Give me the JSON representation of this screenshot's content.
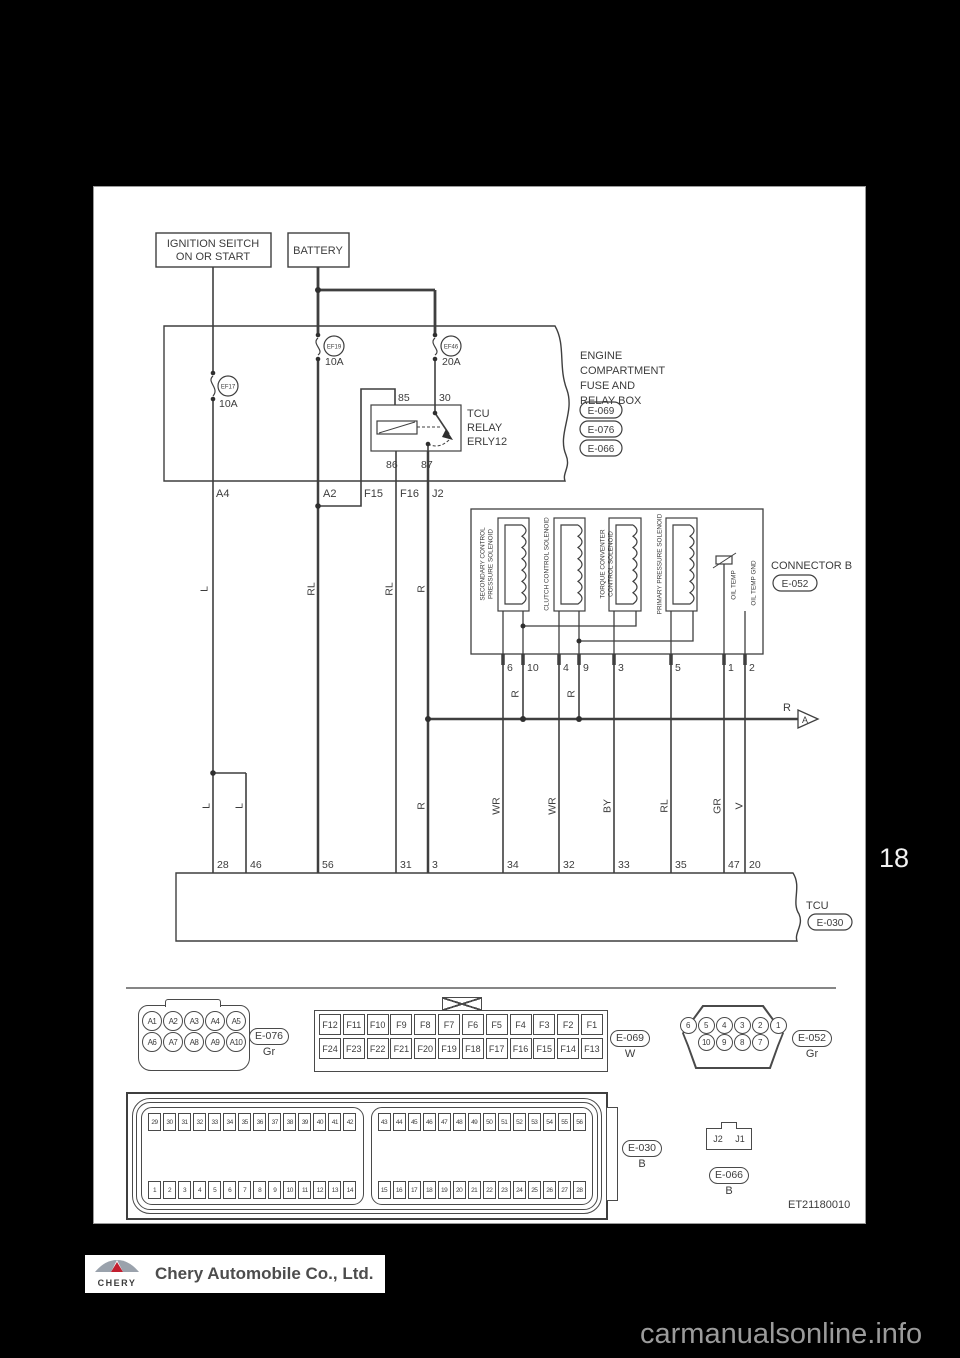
{
  "page": {
    "number": "18",
    "diagram_code": "ET21180010",
    "watermark": "carmanualsonline.info"
  },
  "footer": {
    "brand": "CHERY",
    "company": "Chery Automobile Co., Ltd."
  },
  "power": {
    "ignition_label_1": "IGNITION SEITCH",
    "ignition_label_2": "ON OR START",
    "battery_label": "BATTERY"
  },
  "fusebox": {
    "title_lines": [
      "ENGINE",
      "COMPARTMENT",
      "FUSE AND",
      "RELAY BOX"
    ],
    "badges": [
      "E-069",
      "E-076",
      "E-066"
    ],
    "fuses": {
      "ef17": {
        "id": "EF17",
        "rating": "10A"
      },
      "ef19": {
        "id": "EF19",
        "rating": "10A"
      },
      "ef46": {
        "id": "EF46",
        "rating": "20A"
      }
    },
    "relay": {
      "name_lines": [
        "TCU",
        "RELAY",
        "ERLY12"
      ],
      "pins": {
        "p85": "85",
        "p30": "30",
        "p86": "86",
        "p87": "87"
      }
    },
    "out_pins": [
      "A4",
      "A2",
      "F15",
      "F16",
      "J2"
    ]
  },
  "wires": {
    "a4": "L",
    "a2": "RL",
    "f16": "RL",
    "j2": "R",
    "b10": "R",
    "b9": "R",
    "bus": "R",
    "arrow": "A",
    "t28": "L",
    "t46": "L",
    "t3": "R",
    "t34": "WR",
    "t32": "WR",
    "t33": "BY",
    "t35": "RL",
    "t47": "GR",
    "t20": "V"
  },
  "connector_b": {
    "label": "CONNECTOR B",
    "badge": "E-052",
    "solenoids": {
      "s1": [
        "SECONDARY CONTROL",
        "PRESSURE SOLENOID"
      ],
      "s2": "CLUTCH CONTROL SOLENOID",
      "s3": [
        "TORQUE CONVENTER",
        "CONTROL SOLENOID"
      ],
      "s4": "PRIMARY PRESSURE SOLENOID",
      "oil_temp": "OIL TEMP",
      "oil_temp_gnd": "OIL TEMP GND"
    },
    "pins": [
      "6",
      "10",
      "4",
      "9",
      "3",
      "5",
      "1",
      "2"
    ]
  },
  "tcu": {
    "label": "TCU",
    "badge": "E-030",
    "pins": [
      "28",
      "46",
      "56",
      "31",
      "3",
      "34",
      "32",
      "33",
      "35",
      "47",
      "20"
    ]
  },
  "connectors": {
    "e076": {
      "badge": "E-076",
      "color": "Gr",
      "row1": [
        "A1",
        "A2",
        "A3",
        "A4",
        "A5"
      ],
      "row2": [
        "A6",
        "A7",
        "A8",
        "A9",
        "A10"
      ]
    },
    "e069": {
      "badge": "E-069",
      "color": "W",
      "row1": [
        "F12",
        "F11",
        "F10",
        "F9",
        "F8",
        "F7",
        "F6",
        "F5",
        "F4",
        "F3",
        "F2",
        "F1"
      ],
      "row2": [
        "F24",
        "F23",
        "F22",
        "F21",
        "F20",
        "F19",
        "F18",
        "F17",
        "F16",
        "F15",
        "F14",
        "F13"
      ]
    },
    "e052": {
      "badge": "E-052",
      "color": "Gr",
      "row1": [
        "6",
        "5",
        "4",
        "3",
        "2",
        "1"
      ],
      "row2": [
        "10",
        "9",
        "8",
        "7"
      ]
    },
    "e030": {
      "badge": "E-030",
      "color": "B",
      "left_top": [
        "29",
        "30",
        "31",
        "32",
        "33",
        "34",
        "35",
        "36",
        "37",
        "38",
        "39",
        "40",
        "41",
        "42"
      ],
      "left_bottom": [
        "1",
        "2",
        "3",
        "4",
        "5",
        "6",
        "7",
        "8",
        "9",
        "10",
        "11",
        "12",
        "13",
        "14"
      ],
      "right_top": [
        "43",
        "44",
        "45",
        "46",
        "47",
        "48",
        "49",
        "50",
        "51",
        "52",
        "53",
        "54",
        "55",
        "56"
      ],
      "right_bottom": [
        "15",
        "16",
        "17",
        "18",
        "19",
        "20",
        "21",
        "22",
        "23",
        "24",
        "25",
        "26",
        "27",
        "28"
      ]
    },
    "e066": {
      "badge": "E-066",
      "color": "B",
      "cells": [
        "J2",
        "J1"
      ]
    }
  }
}
